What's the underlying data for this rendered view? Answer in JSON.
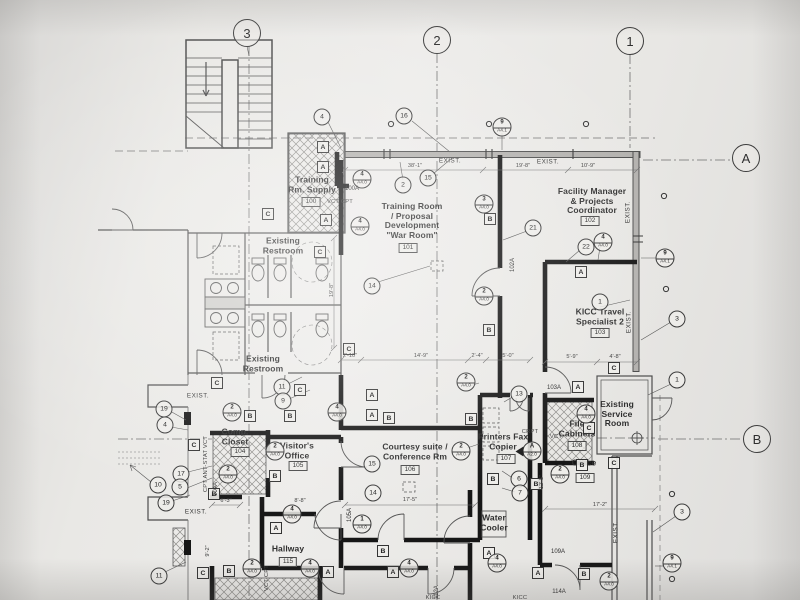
{
  "colors": {
    "paper": "#e9e8e5",
    "ink": "#3a3a3a",
    "new_wall": "#161616",
    "existing_wall": "#4d4d4d"
  },
  "grid_markers": [
    {
      "label": "3",
      "x": 247,
      "y": 33
    },
    {
      "label": "2",
      "x": 437,
      "y": 40
    },
    {
      "label": "1",
      "x": 630,
      "y": 41
    },
    {
      "label": "A",
      "x": 746,
      "y": 158
    },
    {
      "label": "B",
      "x": 757,
      "y": 439
    }
  ],
  "rooms": [
    {
      "lines": [
        "Training",
        "Rm. Supply"
      ],
      "num": "100",
      "x": 312,
      "y": 185,
      "nx": 311,
      "ny": 202
    },
    {
      "lines": [
        "Training Room",
        "/ Proposal",
        "Development",
        "\"War Room\""
      ],
      "num": "101",
      "x": 412,
      "y": 221,
      "nx": 408,
      "ny": 248
    },
    {
      "lines": [
        "Facility Manager",
        "& Projects",
        "Coordinator"
      ],
      "num": "102",
      "x": 592,
      "y": 201,
      "nx": 590,
      "ny": 221
    },
    {
      "lines": [
        "KICC Travel",
        "Specialist 2"
      ],
      "num": "103",
      "x": 600,
      "y": 317,
      "nx": 600,
      "ny": 333
    },
    {
      "lines": [
        "Existing",
        "Restroom"
      ],
      "x": 283,
      "y": 246
    },
    {
      "lines": [
        "Existing",
        "Restroom"
      ],
      "x": 263,
      "y": 364
    },
    {
      "lines": [
        "Comp.",
        "Closet"
      ],
      "num": "104",
      "x": 235,
      "y": 437,
      "nx": 240,
      "ny": 452
    },
    {
      "lines": [
        "Visitor's",
        "Office"
      ],
      "num": "105",
      "x": 297,
      "y": 451,
      "nx": 298,
      "ny": 466
    },
    {
      "lines": [
        "Courtesy suite /",
        "Conference Rm"
      ],
      "num": "106",
      "x": 415,
      "y": 452,
      "nx": 410,
      "ny": 470
    },
    {
      "lines": [
        "Printers Fax",
        "Copier"
      ],
      "num": "107",
      "x": 503,
      "y": 442,
      "nx": 506,
      "ny": 459
    },
    {
      "lines": [
        "File",
        "Cabinets"
      ],
      "num": "108",
      "x": 577,
      "y": 429,
      "nx": 577,
      "ny": 446
    },
    {
      "lines": [
        "Office"
      ],
      "num": "109",
      "x": 584,
      "y": 463,
      "nx": 585,
      "ny": 478
    },
    {
      "lines": [
        "Existing",
        "Service",
        "Room"
      ],
      "x": 617,
      "y": 414
    },
    {
      "lines": [
        "Hallway"
      ],
      "num": "115",
      "x": 288,
      "y": 549,
      "nx": 288,
      "ny": 562
    },
    {
      "lines": [
        "Water",
        "Cooler"
      ],
      "x": 494,
      "y": 523
    }
  ],
  "wall_tags": [
    {
      "label": "A",
      "x": 323,
      "y": 147
    },
    {
      "label": "A",
      "x": 323,
      "y": 167
    },
    {
      "label": "A",
      "x": 326,
      "y": 220
    },
    {
      "label": "A",
      "x": 372,
      "y": 395
    },
    {
      "label": "A",
      "x": 372,
      "y": 415
    },
    {
      "label": "A",
      "x": 276,
      "y": 528
    },
    {
      "label": "A",
      "x": 328,
      "y": 572
    },
    {
      "label": "A",
      "x": 393,
      "y": 572
    },
    {
      "label": "A",
      "x": 489,
      "y": 553
    },
    {
      "label": "A",
      "x": 538,
      "y": 573
    },
    {
      "label": "A",
      "x": 578,
      "y": 387
    },
    {
      "label": "A",
      "x": 581,
      "y": 272
    },
    {
      "label": "B",
      "x": 490,
      "y": 219
    },
    {
      "label": "B",
      "x": 489,
      "y": 330
    },
    {
      "label": "B",
      "x": 250,
      "y": 416
    },
    {
      "label": "B",
      "x": 290,
      "y": 416
    },
    {
      "label": "B",
      "x": 389,
      "y": 418
    },
    {
      "label": "B",
      "x": 275,
      "y": 476
    },
    {
      "label": "B",
      "x": 214,
      "y": 494
    },
    {
      "label": "B",
      "x": 383,
      "y": 551
    },
    {
      "label": "B",
      "x": 229,
      "y": 571
    },
    {
      "label": "B",
      "x": 584,
      "y": 574
    },
    {
      "label": "B",
      "x": 536,
      "y": 484
    },
    {
      "label": "B",
      "x": 582,
      "y": 465
    },
    {
      "label": "B",
      "x": 471,
      "y": 419
    },
    {
      "label": "B",
      "x": 493,
      "y": 479
    },
    {
      "label": "C",
      "x": 268,
      "y": 214
    },
    {
      "label": "C",
      "x": 320,
      "y": 252
    },
    {
      "label": "C",
      "x": 217,
      "y": 383
    },
    {
      "label": "C",
      "x": 194,
      "y": 445
    },
    {
      "label": "C",
      "x": 203,
      "y": 573
    },
    {
      "label": "C",
      "x": 349,
      "y": 349
    },
    {
      "label": "C",
      "x": 614,
      "y": 368
    },
    {
      "label": "C",
      "x": 614,
      "y": 463
    },
    {
      "label": "C",
      "x": 589,
      "y": 428
    },
    {
      "label": "C",
      "x": 300,
      "y": 390
    }
  ],
  "callouts_split": [
    {
      "top": "4",
      "bot": "A4.0",
      "x": 362,
      "y": 179
    },
    {
      "top": "4",
      "bot": "A4.0",
      "x": 360,
      "y": 226
    },
    {
      "top": "3",
      "bot": "A4.0",
      "x": 484,
      "y": 204
    },
    {
      "top": "2",
      "bot": "A4.0",
      "x": 484,
      "y": 296
    },
    {
      "top": "4",
      "bot": "A4.0",
      "x": 603,
      "y": 242
    },
    {
      "top": "9",
      "bot": "A4.1",
      "x": 502,
      "y": 127
    },
    {
      "top": "9",
      "bot": "A4.1",
      "x": 665,
      "y": 258
    },
    {
      "top": "9",
      "bot": "A4.1",
      "x": 672,
      "y": 563
    },
    {
      "top": "2",
      "bot": "A4.0",
      "x": 232,
      "y": 412
    },
    {
      "top": "2",
      "bot": "A4.0",
      "x": 228,
      "y": 474
    },
    {
      "top": "2",
      "bot": "A4.0",
      "x": 275,
      "y": 451
    },
    {
      "top": "4",
      "bot": "A4.0",
      "x": 337,
      "y": 412
    },
    {
      "top": "2",
      "bot": "A4.0",
      "x": 466,
      "y": 382
    },
    {
      "top": "4",
      "bot": "A4.0",
      "x": 292,
      "y": 514
    },
    {
      "top": "1",
      "bot": "A4.0",
      "x": 362,
      "y": 524
    },
    {
      "top": "2",
      "bot": "A4.0",
      "x": 252,
      "y": 568
    },
    {
      "top": "4",
      "bot": "A4.0",
      "x": 310,
      "y": 568
    },
    {
      "top": "4",
      "bot": "A4.0",
      "x": 409,
      "y": 568
    },
    {
      "top": "4",
      "bot": "A4.0",
      "x": 497,
      "y": 563
    },
    {
      "top": "2",
      "bot": "A4.0",
      "x": 560,
      "y": 474
    },
    {
      "top": "4",
      "bot": "A4.0",
      "x": 586,
      "y": 414
    },
    {
      "top": "2",
      "bot": "A4.0",
      "x": 609,
      "y": 581
    },
    {
      "top": "2",
      "bot": "A4.0",
      "x": 461,
      "y": 451
    },
    {
      "top": "A",
      "bot": "A2.0",
      "x": 532,
      "y": 451,
      "section": true
    }
  ],
  "callouts_plain": [
    {
      "label": "4",
      "x": 322,
      "y": 117
    },
    {
      "label": "16",
      "x": 404,
      "y": 116
    },
    {
      "label": "2",
      "x": 403,
      "y": 185
    },
    {
      "label": "15",
      "x": 428,
      "y": 178
    },
    {
      "label": "14",
      "x": 372,
      "y": 286
    },
    {
      "label": "21",
      "x": 533,
      "y": 228
    },
    {
      "label": "22",
      "x": 586,
      "y": 247
    },
    {
      "label": "1",
      "x": 600,
      "y": 302
    },
    {
      "label": "3",
      "x": 677,
      "y": 319
    },
    {
      "label": "1",
      "x": 677,
      "y": 380
    },
    {
      "label": "3",
      "x": 682,
      "y": 512
    },
    {
      "label": "19",
      "x": 164,
      "y": 409
    },
    {
      "label": "4",
      "x": 165,
      "y": 425
    },
    {
      "label": "17",
      "x": 181,
      "y": 474
    },
    {
      "label": "10",
      "x": 158,
      "y": 485
    },
    {
      "label": "5",
      "x": 180,
      "y": 487
    },
    {
      "label": "19",
      "x": 166,
      "y": 503
    },
    {
      "label": "11",
      "x": 159,
      "y": 576
    },
    {
      "label": "11",
      "x": 282,
      "y": 387
    },
    {
      "label": "9",
      "x": 283,
      "y": 401
    },
    {
      "label": "13",
      "x": 519,
      "y": 394
    },
    {
      "label": "6",
      "x": 519,
      "y": 479
    },
    {
      "label": "7",
      "x": 520,
      "y": 493
    },
    {
      "label": "15",
      "x": 372,
      "y": 464
    },
    {
      "label": "14",
      "x": 373,
      "y": 493
    }
  ],
  "door_tags": [
    {
      "label": "100A",
      "x": 352,
      "y": 189
    },
    {
      "label": "102A",
      "x": 513,
      "y": 265,
      "v": true
    },
    {
      "label": "103A",
      "x": 554,
      "y": 388
    },
    {
      "label": "104A",
      "x": 216,
      "y": 489,
      "v": true
    },
    {
      "label": "105A",
      "x": 350,
      "y": 515,
      "v": true
    },
    {
      "label": "109A",
      "x": 558,
      "y": 552
    },
    {
      "label": "114A",
      "x": 559,
      "y": 592
    },
    {
      "label": "112A",
      "x": 437,
      "y": 592,
      "v": true
    }
  ],
  "exist_labels": [
    {
      "text": "EXIST.",
      "x": 450,
      "y": 161
    },
    {
      "text": "EXIST.",
      "x": 548,
      "y": 162
    },
    {
      "text": "EXIST.",
      "x": 198,
      "y": 396
    },
    {
      "text": "EXIST.",
      "x": 196,
      "y": 512
    },
    {
      "text": "EXIST.",
      "x": 628,
      "y": 212,
      "v": true
    },
    {
      "text": "EXIST.",
      "x": 629,
      "y": 322,
      "v": true
    },
    {
      "text": "EXIST.",
      "x": 616,
      "y": 532,
      "v": true
    }
  ],
  "notes": [
    {
      "text": "VCT CPT",
      "x": 340,
      "y": 202
    },
    {
      "text": "CPT ANT-STAT VCT",
      "x": 206,
      "y": 464,
      "v": true
    },
    {
      "text": "VCT CPT",
      "x": 267,
      "y": 578,
      "v": true
    },
    {
      "text": "CRPT",
      "x": 530,
      "y": 432
    },
    {
      "text": "VCT",
      "x": 556,
      "y": 437
    },
    {
      "text": "KICC",
      "x": 433,
      "y": 598
    },
    {
      "text": "KICC",
      "x": 520,
      "y": 598
    }
  ],
  "dimensions": [
    {
      "text": "38'-1\"",
      "x": 415,
      "y": 166
    },
    {
      "text": "19'-8\"",
      "x": 523,
      "y": 166
    },
    {
      "text": "10'-9\"",
      "x": 588,
      "y": 166
    },
    {
      "text": "2'-10\"",
      "x": 350,
      "y": 356
    },
    {
      "text": "14'-9\"",
      "x": 421,
      "y": 356
    },
    {
      "text": "2'-4\"",
      "x": 477,
      "y": 356
    },
    {
      "text": "5'-0\"",
      "x": 508,
      "y": 356
    },
    {
      "text": "5'-9\"",
      "x": 572,
      "y": 357
    },
    {
      "text": "4'-8\"",
      "x": 615,
      "y": 357
    },
    {
      "text": "17'-5\"",
      "x": 410,
      "y": 500
    },
    {
      "text": "8'-8\"",
      "x": 300,
      "y": 501
    },
    {
      "text": "17'-2\"",
      "x": 600,
      "y": 505
    },
    {
      "text": "6'-3\"",
      "x": 226,
      "y": 501
    },
    {
      "text": "19'-8\"",
      "x": 332,
      "y": 290,
      "v": true
    },
    {
      "text": "12'-5\"",
      "x": 542,
      "y": 482,
      "v": true
    },
    {
      "text": "9'-2\"",
      "x": 208,
      "y": 551,
      "v": true
    }
  ]
}
